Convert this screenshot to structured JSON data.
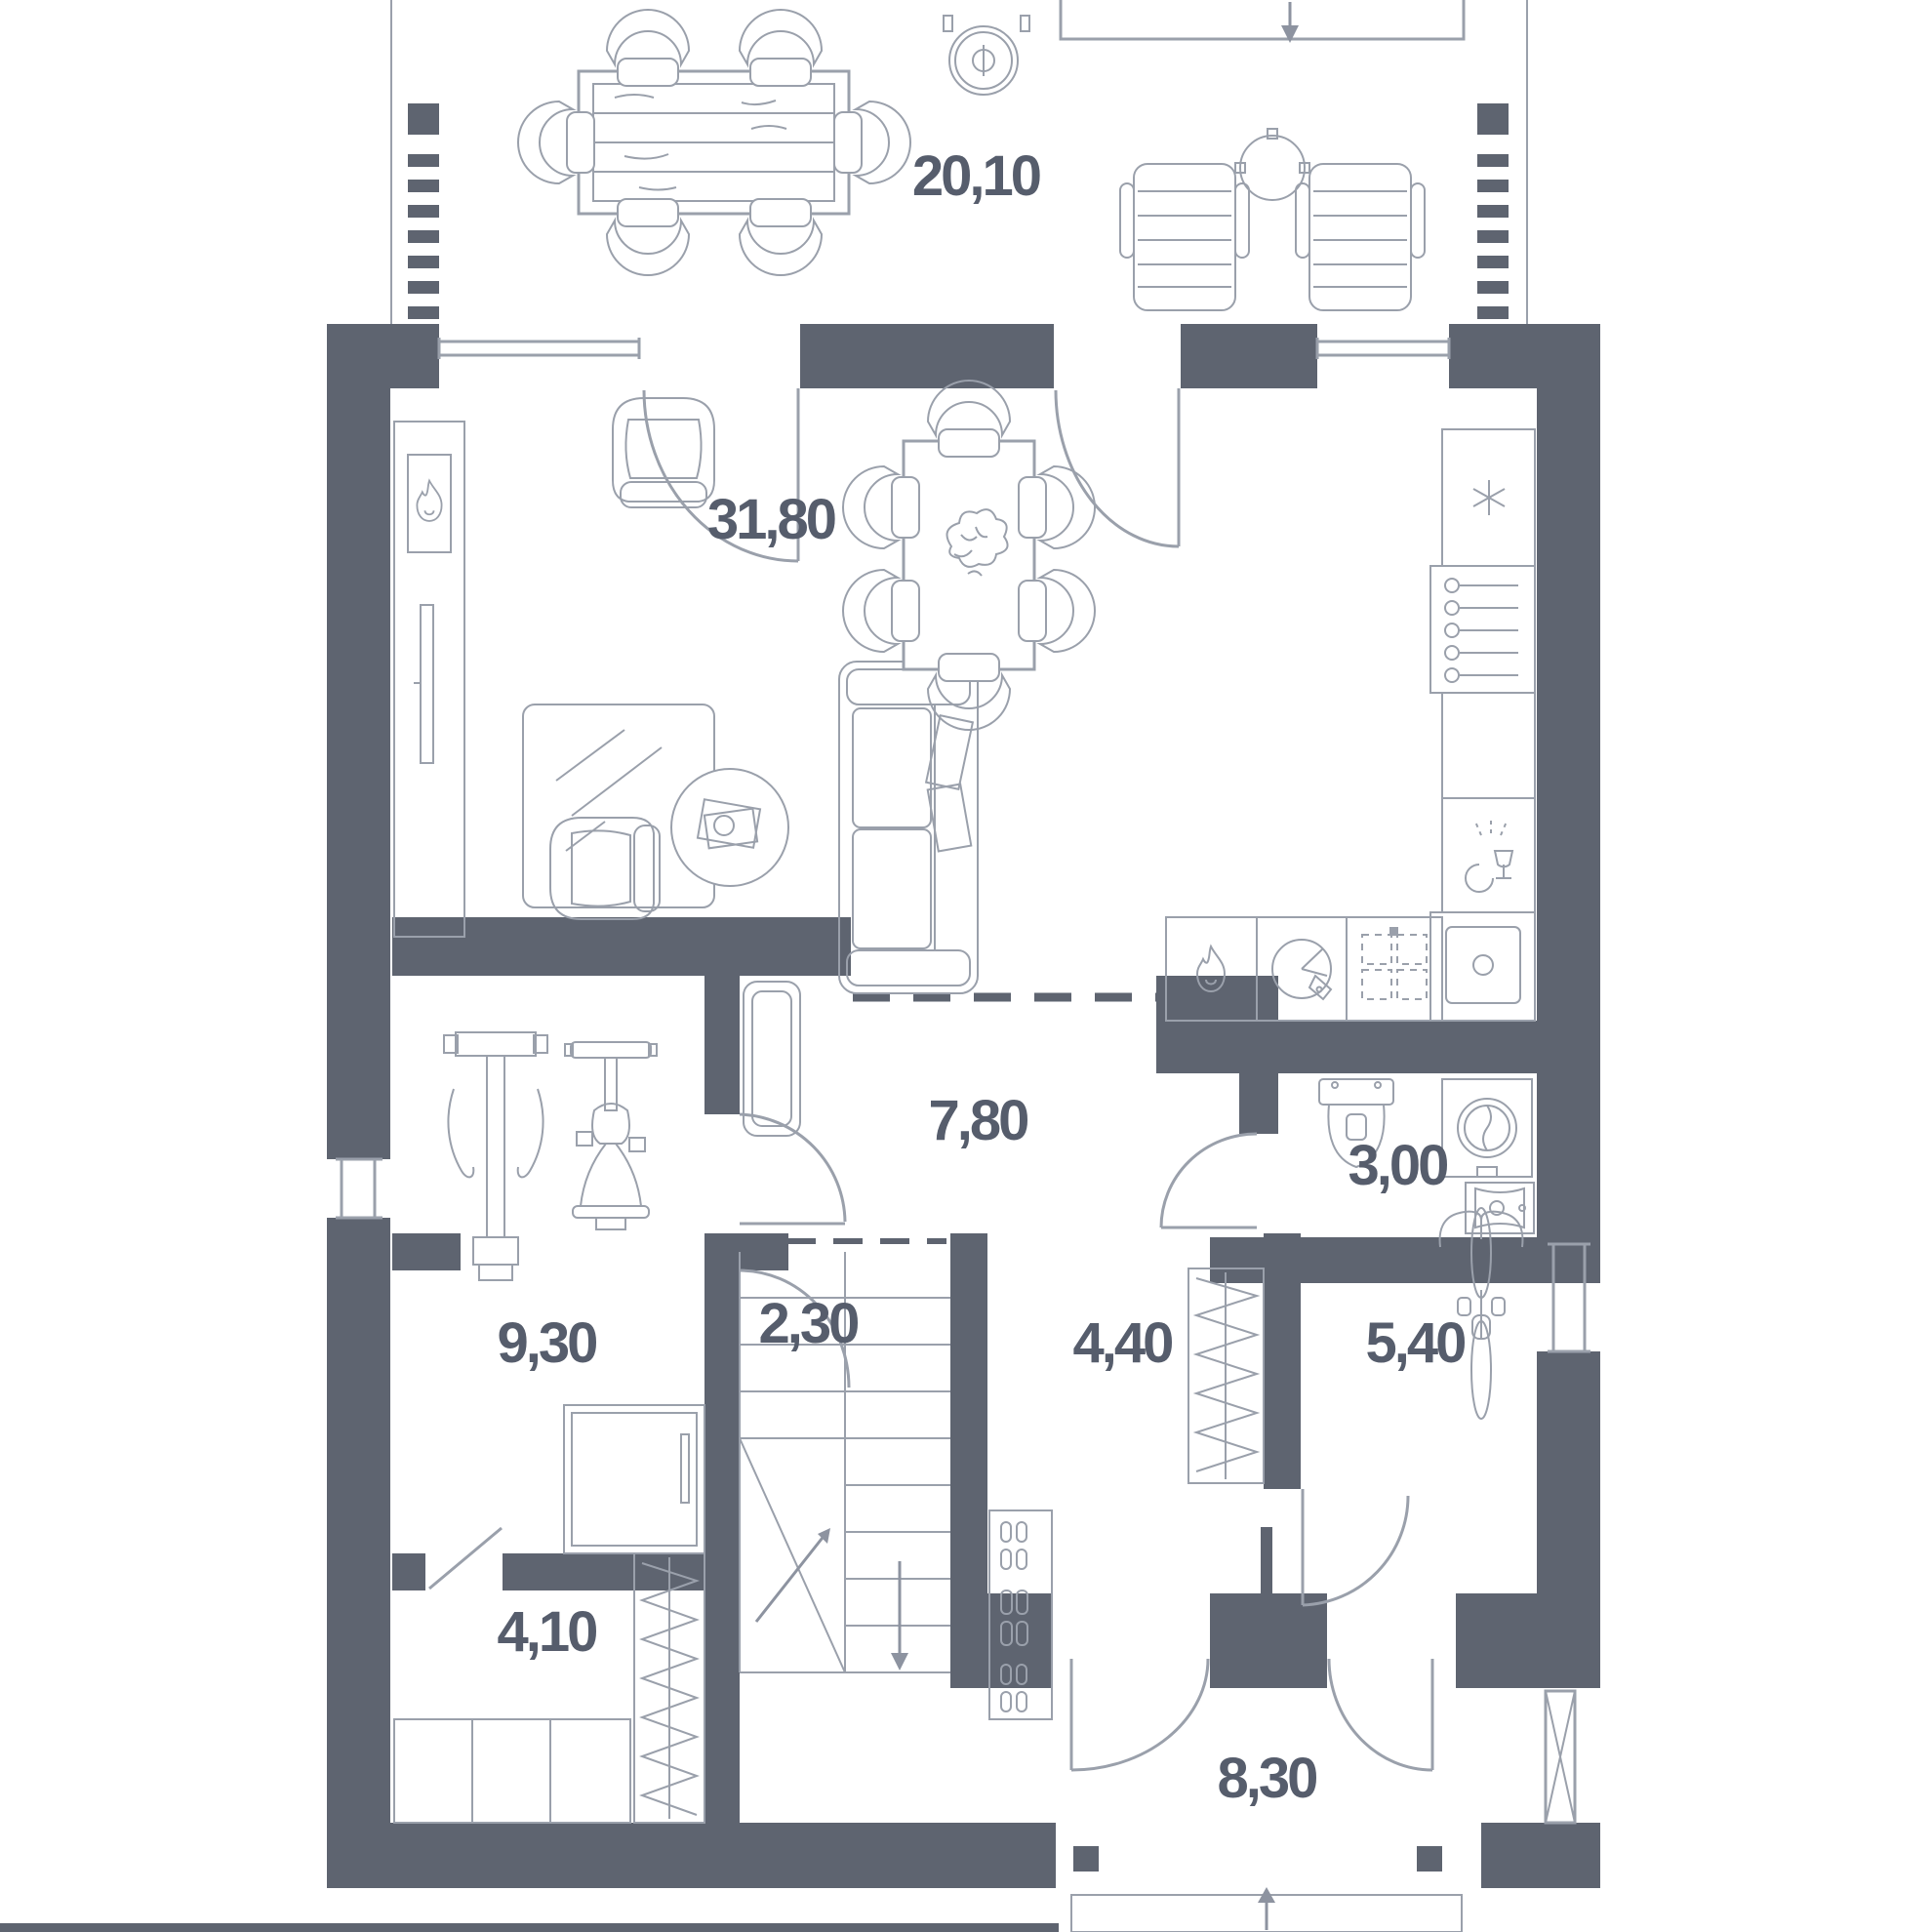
{
  "plan": {
    "title": "ground-floor architectural plan",
    "wall_color": "#5e6470",
    "line_color": "#9aa0ab",
    "label_color": "#565d6c",
    "rooms": {
      "terrace": {
        "area": "20,10"
      },
      "living_kitchen": {
        "area": "31,80"
      },
      "hallway": {
        "area": "7,80"
      },
      "bathroom": {
        "area": "3,00"
      },
      "room_930": {
        "area": "9,30"
      },
      "stairs": {
        "area": "2,30"
      },
      "entry": {
        "area": "4,40"
      },
      "storage": {
        "area": "5,40"
      },
      "closet": {
        "area": "4,10"
      },
      "porch": {
        "area": "8,30"
      }
    },
    "icons": [
      "fireplace-flame-icon",
      "tv-icon",
      "stove-flame-icon",
      "oven-icon",
      "hob-icon",
      "snowflake-icon",
      "wine-rack-icon",
      "dishwasher-icon",
      "kitchen-sink-icon",
      "toilet-icon",
      "washing-machine-icon",
      "washbasin-icon",
      "fire-pit-icon",
      "entry-arrow-icon",
      "stairs-up-arrow-icon",
      "stairs-down-arrow-icon",
      "window-cross-icon"
    ],
    "furniture": [
      "dining-table",
      "dining-chairs",
      "lounge-chairs",
      "side-table",
      "sofa",
      "armchairs",
      "coffee-table",
      "rug",
      "gym-machine",
      "exercise-bike",
      "hall-bench",
      "wardrobe-sliding",
      "clothes-rail",
      "shoe-rack",
      "cabinets",
      "bicycle",
      "stairs",
      "porch-steps"
    ]
  }
}
